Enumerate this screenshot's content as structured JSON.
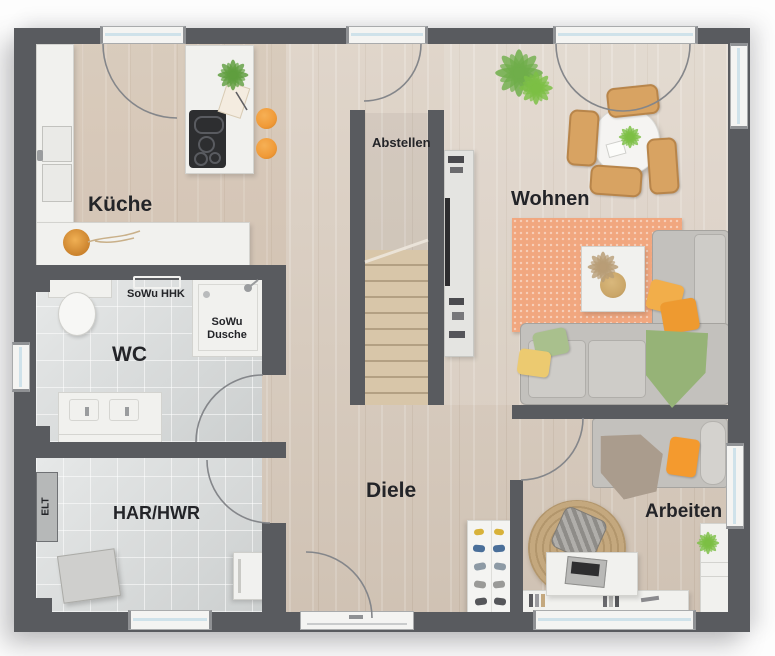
{
  "labels": {
    "kitchen": "Küche",
    "wc": "WC",
    "utility": "HAR/HWR",
    "electrical": "ELT",
    "hall": "Diele",
    "storage": "Abstellen",
    "living": "Wohnen",
    "office": "Arbeiten",
    "towel_radiator": "SoWu HHK",
    "shower": "SoWu Dusche"
  },
  "colors": {
    "wall": "#595b5f",
    "wood_floor": "#d7cabc",
    "tile_floor": "#d9dcdc",
    "stair_tread": "#d8c6a9",
    "accent_orange": "#f09a38",
    "rug_salmon": "#f1a77f",
    "rug_jute": "#c4a87e",
    "sofa_gray": "#c3c1bd",
    "chair_tan": "#d8a362",
    "pillow_green": "#a9c08d",
    "pillow_yellow": "#ecca70",
    "blanket_green": "#96b377",
    "plant_green": "#6fae4a",
    "window_glass": "#cfe2ea",
    "label_text": "#232428"
  }
}
